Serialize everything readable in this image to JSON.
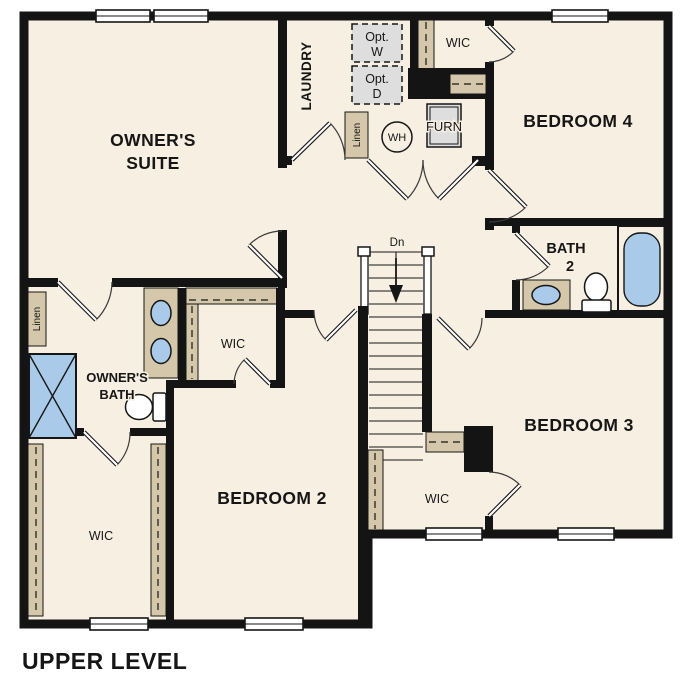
{
  "title": "UPPER LEVEL",
  "colors": {
    "paper": "#ffffff",
    "floor": "#f7efe2",
    "wall": "#141414",
    "shelf": "#d5c8aa",
    "fixture_blue": "#a9cae8",
    "appliance_gray": "#dedede"
  },
  "rooms": {
    "owners_suite": {
      "line1": "OWNER'S",
      "line2": "SUITE"
    },
    "laundry": {
      "label": "LAUNDRY"
    },
    "bedroom_4": {
      "label": "BEDROOM 4"
    },
    "bedroom_3": {
      "label": "BEDROOM 3"
    },
    "bedroom_2": {
      "label": "BEDROOM 2"
    },
    "bath_2": {
      "line1": "BATH",
      "line2": "2"
    },
    "owners_bath": {
      "line1": "OWNER'S",
      "line2": "BATH"
    },
    "wic_bedroom4": {
      "label": "WIC"
    },
    "wic_owners": {
      "label": "WIC"
    },
    "wic_lower_left": {
      "label": "WIC"
    },
    "wic_bedroom3": {
      "label": "WIC"
    }
  },
  "closets": {
    "linen_hall": {
      "label": "Linen"
    },
    "linen_laundry": {
      "label": "Linen"
    }
  },
  "fixtures": {
    "washer_opt": {
      "line1": "Opt.",
      "line2": "W"
    },
    "dryer_opt": {
      "line1": "Opt.",
      "line2": "D"
    },
    "water_heater": {
      "label": "WH"
    },
    "furnace": {
      "label": "FURN"
    }
  },
  "stairs": {
    "down_label": "Dn"
  }
}
